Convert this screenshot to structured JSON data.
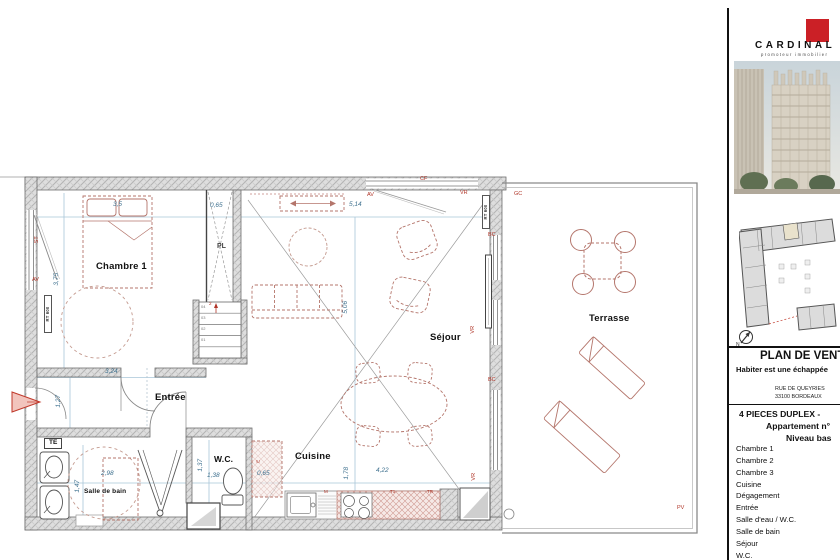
{
  "plan": {
    "room_labels": {
      "chambre1": "Chambre 1",
      "sejour": "Séjour",
      "terrasse": "Terrasse",
      "entree": "Entrée",
      "cuisine": "Cuisine",
      "wc": "W.C.",
      "salle_de_bain": "Salle de bain",
      "placard": "PL",
      "te": "TE"
    },
    "dimensions": {
      "chambre_width": "3,5",
      "placard_width": "0,65",
      "sejour_width": "5,14",
      "chambre_height": "3,75",
      "sejour_height": "5,06",
      "entree_width": "3,24",
      "entree_recess": "1,27",
      "sdb_width": "2,98",
      "sdb_height": "1,47",
      "wc_height": "1,37",
      "wc_width": "1,38",
      "kitchen_recess": "0,65",
      "kitchen_depth": "1,78",
      "kitchen_width": "4,22"
    },
    "tags": {
      "cf": "CF",
      "av_top": "AV",
      "vr_top": "VR",
      "gc": "GC",
      "bc_upper": "BC",
      "bc_lower": "BC",
      "vr_right": "VR",
      "vr_kitchen": "VR",
      "pv": "PV",
      "st_left": "ST",
      "av_left": "AV",
      "rt600_left": "RT 600",
      "rt600_right": "RT 600",
      "e_kitchen": "E",
      "m_counter": "M",
      "t1_counter": "T1",
      "tr_counter": "TR",
      "stair_direction": "2"
    },
    "stair_steps": [
      "04",
      "03",
      "02",
      "01"
    ],
    "north_label": "N"
  },
  "sidebar": {
    "brand": {
      "name": "CARDINAL",
      "tagline": "promoteur immobilier"
    },
    "title_block": {
      "title": "PLAN DE VENTE",
      "slogan": "Habiter est une échappée",
      "address_line1": "RUE DE QUEYRIES",
      "address_line2": "33100 BORDEAUX"
    },
    "apartment": {
      "line1": "4 PIECES DUPLEX - ",
      "line2": "Appartement n°",
      "line3": "Niveau bas"
    },
    "room_list": [
      "Chambre 1",
      "Chambre 2",
      "Chambre 3",
      "Cuisine",
      "Dégagement",
      "Entrée",
      "Salle d'eau / W.C.",
      "Salle de bain",
      "Séjour",
      "W.C."
    ]
  },
  "colors": {
    "logo_red": "#cb2026",
    "tag_red": "#b03528",
    "dimension_blue": "#3f718f",
    "furniture_red": "#b4756b",
    "wall_gray": "#dedede"
  }
}
